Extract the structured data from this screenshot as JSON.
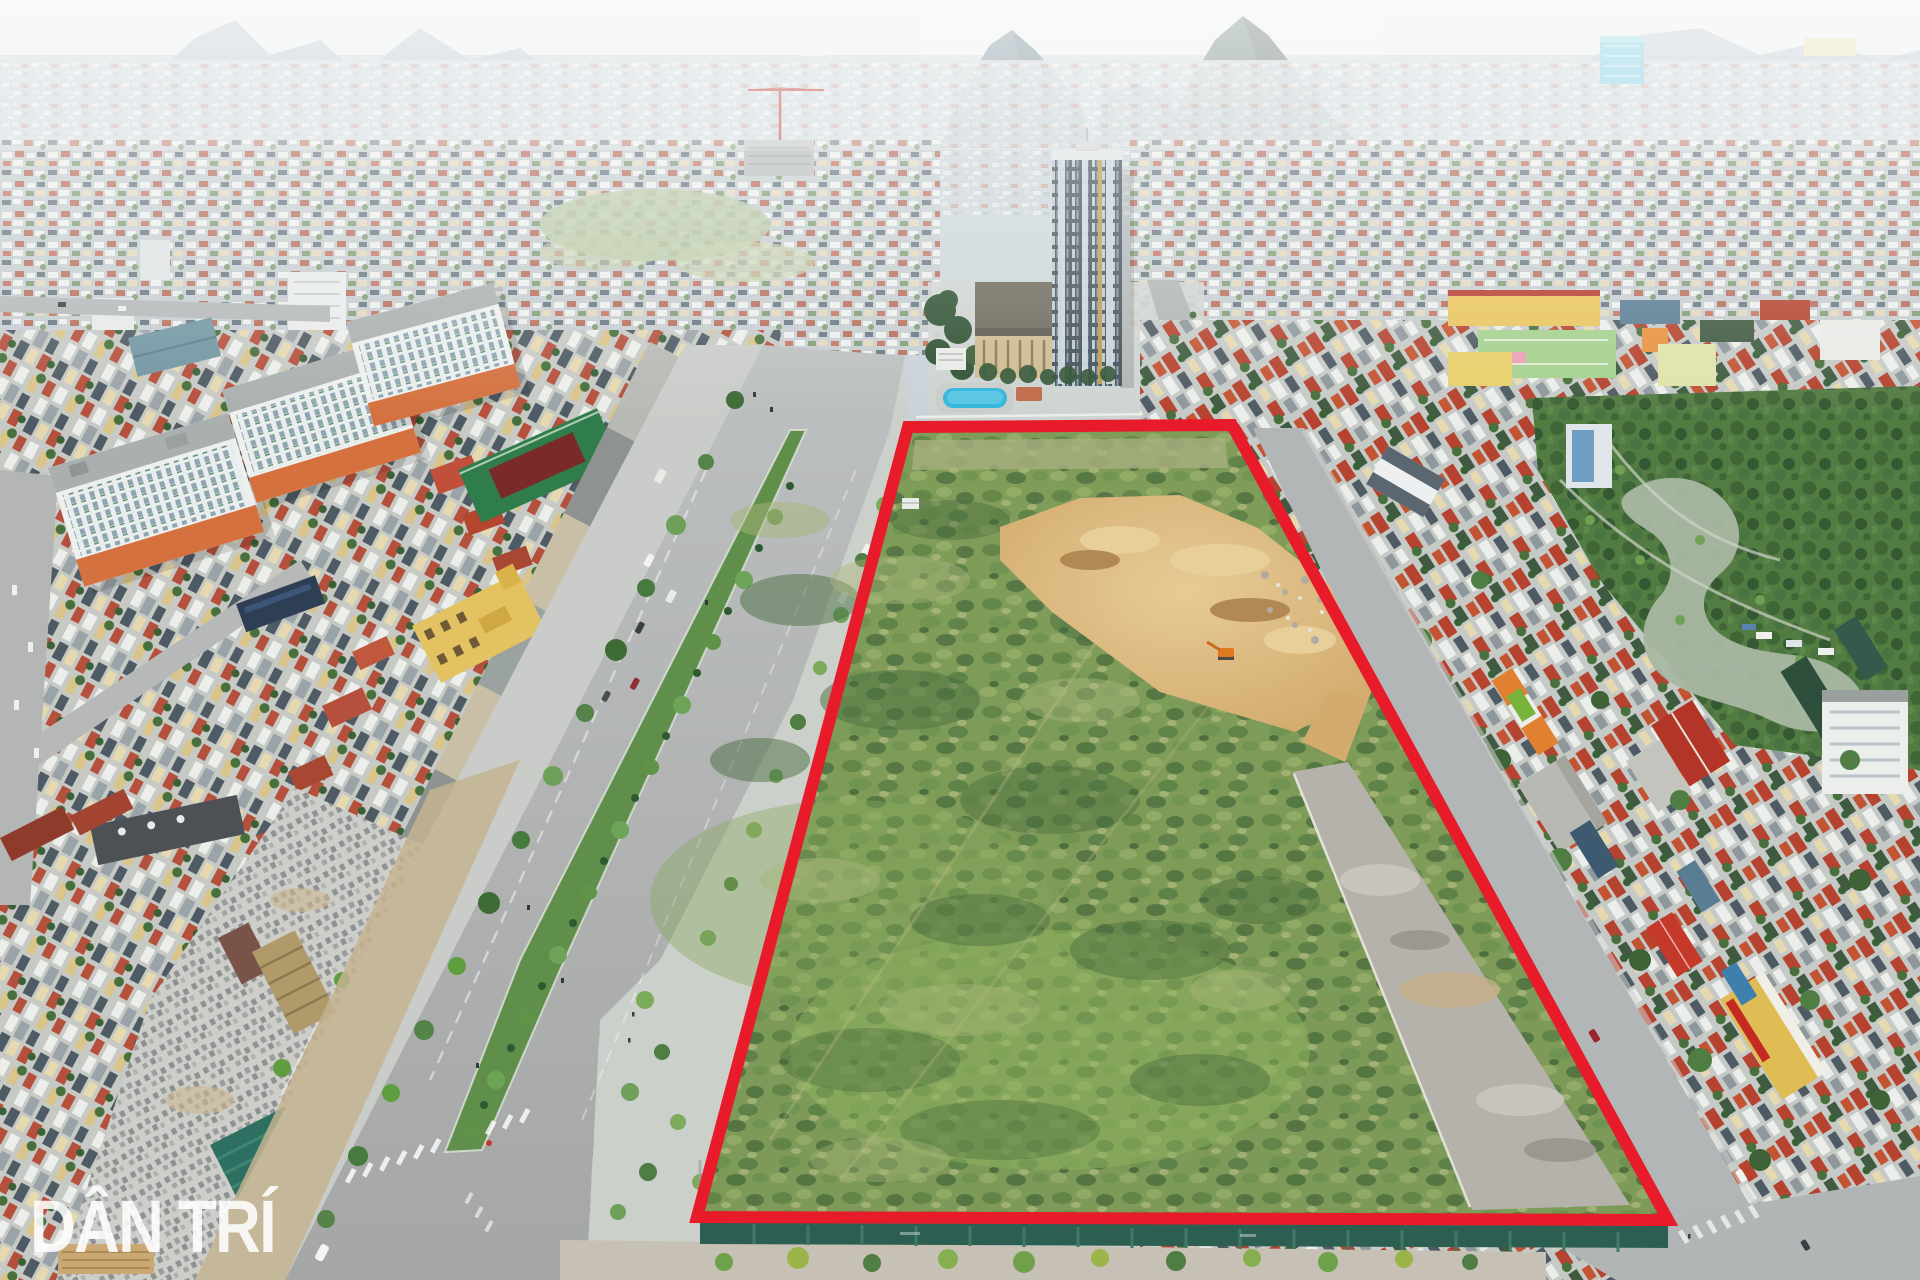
{
  "meta": {
    "type": "aerial-drone-photograph",
    "subject": "vacant urban development plot outlined in red beside a wide boulevard, dense Vietnamese cityscape with karst mountains in haze",
    "width_px": 1920,
    "height_px": 1280
  },
  "watermark": {
    "text": "DÂN TRÍ",
    "fill": "#ffffff",
    "opacity": 0.88
  },
  "highlight": {
    "name": "vacant-plot-boundary",
    "points": "908,427 1232,425 1668,1220 697,1217",
    "color": "#e81b2b",
    "stroke_width": 12
  },
  "palette": {
    "sky_top": "#f0f1f0",
    "sky_bottom": "#d9e0e3",
    "mountain_far": "#b7c4cd",
    "mountain_mid": "#5d7480",
    "mountain_near": "#3e5349",
    "road_grey": "#b0b3b4",
    "sidewalk_grey": "#ccd0cb",
    "scrub_green": "#7d9a58",
    "dirt_tan": "#d3ab6e",
    "pool_blue": "#35b6dc",
    "construction_fence_teal": "#2c5f52",
    "tower_facade": "#45525c",
    "apartment_orange": "#d4713f",
    "park_green": "#567f45"
  },
  "scene": {
    "areas": [
      "sky-and-karst-mountains",
      "distant-hazy-cityscape",
      "central-highrise-complex-with-pool",
      "main-boulevard-with-palm-median",
      "left-residential-district",
      "construction-zone-unfinished-shells",
      "vacant-plot-with-red-outline",
      "excavation-dirt-area-with-excavator",
      "old-pavement-strip-inside-plot",
      "right-residential-district",
      "city-park-with-pond",
      "bottom-construction-hoarding-and-trees"
    ]
  }
}
